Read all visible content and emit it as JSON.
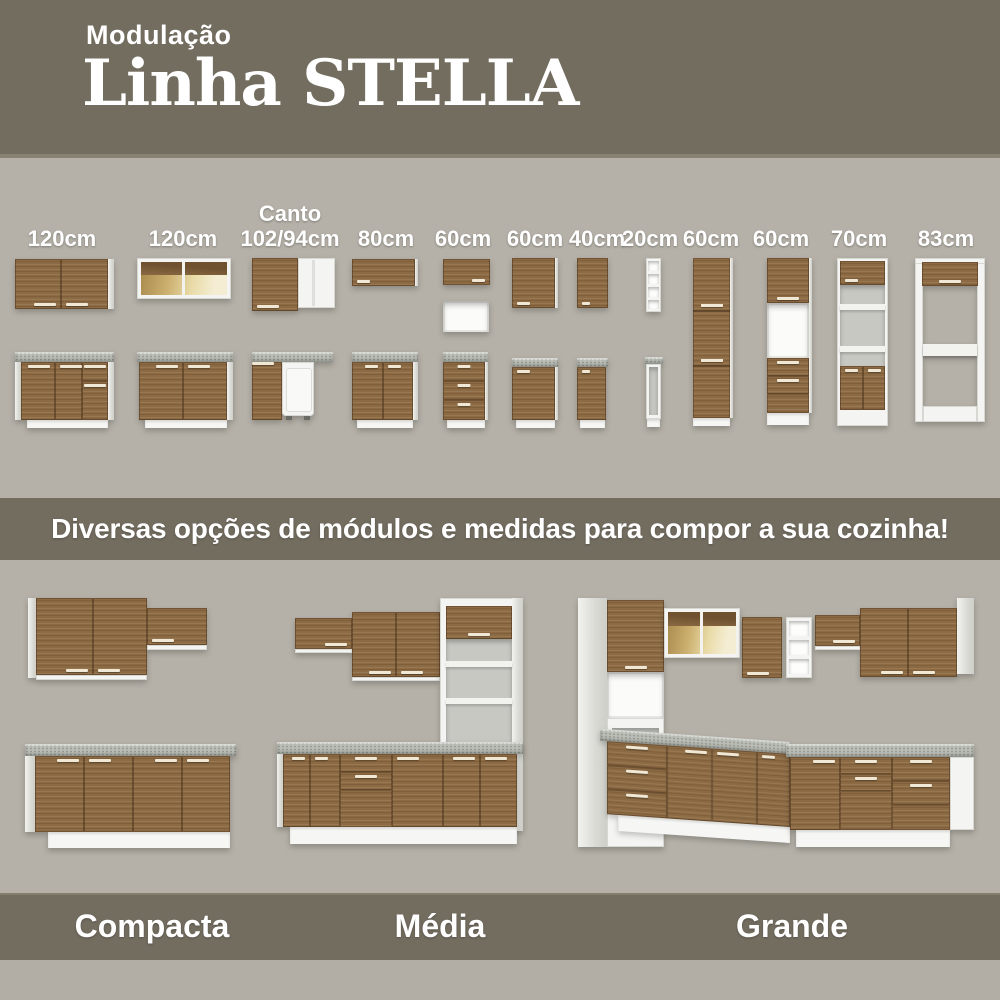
{
  "header": {
    "kicker": "Modulação",
    "title": "Linha STELLA"
  },
  "modules": {
    "columns": [
      {
        "label": "120cm"
      },
      {
        "label": "120cm"
      },
      {
        "label_line1": "Canto",
        "label": "102/94cm"
      },
      {
        "label": "80cm"
      },
      {
        "label": "60cm"
      },
      {
        "label": "60cm"
      },
      {
        "label": "40cm"
      },
      {
        "label": "20cm"
      },
      {
        "label": "60cm"
      },
      {
        "label": "60cm"
      },
      {
        "label": "70cm"
      },
      {
        "label": "83cm"
      }
    ]
  },
  "divider": {
    "text": "Diversas opções de módulos e medidas para compor a sua cozinha!"
  },
  "kitchens": [
    {
      "label": "Compacta"
    },
    {
      "label": "Média"
    },
    {
      "label": "Grande"
    }
  ],
  "colors": {
    "band_olive": "#736d60",
    "background": "#b5b1a8",
    "wood": "#8c6b44",
    "counter_gray": "#bbbeb6",
    "cabinet_white": "#f4f4f2",
    "glass_glow": "#e9dba8",
    "text_white": "#ffffff"
  }
}
